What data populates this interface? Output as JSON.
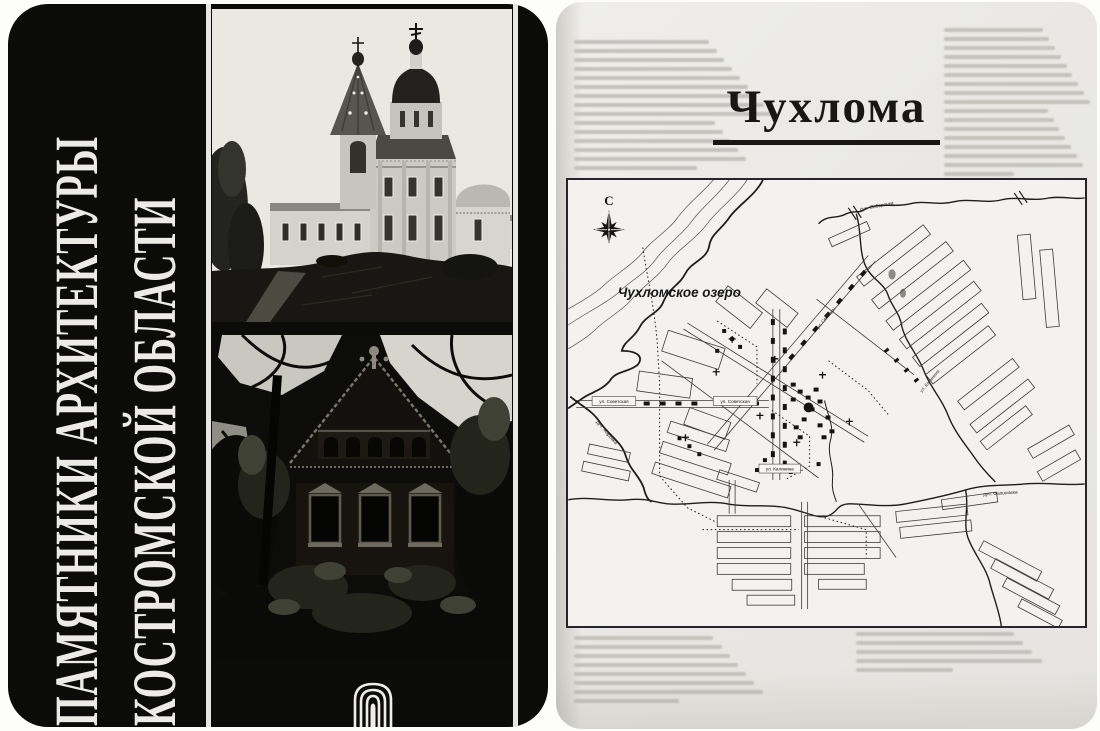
{
  "cover": {
    "title_lines": [
      "ПАМЯТНИКИ АРХИТЕКТУРЫ",
      "КОСТРОМСКОЙ ОБЛАСТИ"
    ]
  },
  "page": {
    "title": "Чухлома",
    "map": {
      "compass_label": "С",
      "lake_label": "Чухломское озеро",
      "street_label_sovetskaya": "ул. Советская",
      "street_label_kalinina": "ул. Калинина",
      "street_label_svobody": "ул. Свободы",
      "stream_label_top": "руч. Соборенка",
      "stream_label_left": "руч. Жаровка",
      "stream_label_right": "руч. Фалиновка"
    }
  },
  "colors": {
    "cover_bg": "#0b0b0a",
    "cover_text": "#ecebe7",
    "page_bg": "#e9e8e4",
    "map_bg": "#f3f2ee",
    "map_ink": "#2b2b28"
  }
}
